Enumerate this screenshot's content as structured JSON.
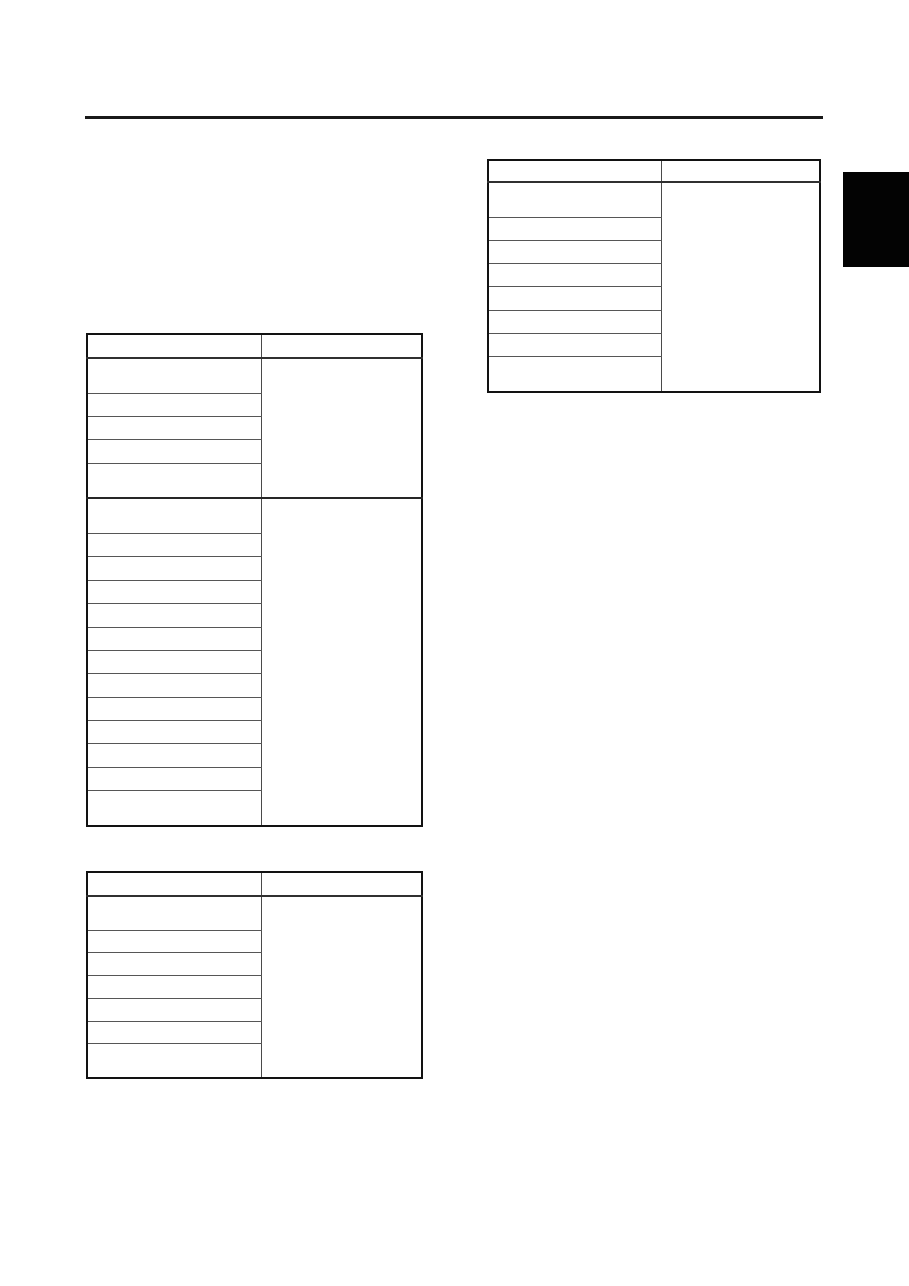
{
  "page": {
    "background": "#ffffff",
    "ink_color": "#1a1a1a",
    "row_line_color": "#4a4a4a"
  },
  "section_tab": {
    "color": "#000000"
  },
  "tables": [
    {
      "id": "table-top-right",
      "header": [
        "",
        ""
      ],
      "left_rows": [
        "",
        "",
        "",
        "",
        "",
        "",
        "",
        ""
      ],
      "merged_sections": [
        8
      ],
      "merged_values": [
        ""
      ]
    },
    {
      "id": "table-left-large",
      "header": [
        "",
        ""
      ],
      "left_rows": [
        "",
        "",
        "",
        "",
        "",
        "",
        "",
        "",
        "",
        "",
        "",
        "",
        "",
        "",
        "",
        "",
        "",
        ""
      ],
      "merged_sections": [
        5,
        13
      ],
      "merged_values": [
        "",
        ""
      ]
    },
    {
      "id": "table-bottom-left",
      "header": [
        "",
        ""
      ],
      "left_rows": [
        "",
        "",
        "",
        "",
        "",
        "",
        ""
      ],
      "merged_sections": [
        7
      ],
      "merged_values": [
        ""
      ]
    }
  ]
}
